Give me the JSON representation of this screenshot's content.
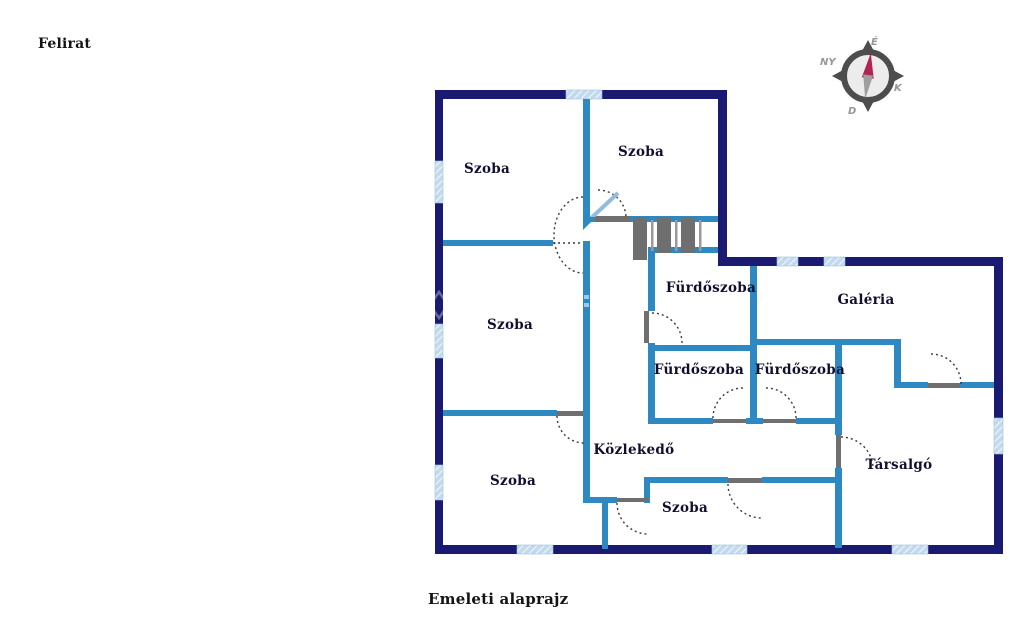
{
  "captions": {
    "top_left": "Felirat",
    "bottom": "Emeleti alaprajz"
  },
  "compass": {
    "north_label": "É",
    "west_label": "NY",
    "east_label": "K",
    "south_label": "D"
  },
  "rooms": [
    {
      "label": "Szoba"
    },
    {
      "label": "Szoba"
    },
    {
      "label": "Fürdőszoba"
    },
    {
      "label": "Galéria"
    },
    {
      "label": "Szoba"
    },
    {
      "label": "Fürdőszoba"
    },
    {
      "label": "Fürdőszoba"
    },
    {
      "label": "Közlekedő"
    },
    {
      "label": "Szoba"
    },
    {
      "label": "Társalgó"
    },
    {
      "label": "Szoba"
    }
  ],
  "palette": {
    "exterior_wall": "#1a1a73",
    "interior_wall": "#2e89c2",
    "window_fill": "#c3daee",
    "window_stripe": "#eff6fc",
    "stairs_gray": "#6f6f6f",
    "threshold_gray": "#6f6f6f",
    "door_arc": "#3a3a3a",
    "door_leaf": "#93bcdd",
    "compass_ring": "#4d4d4d",
    "compass_needle_north": "#b02355",
    "compass_needle_south": "#9f9f9f",
    "label_text": "#10102e"
  }
}
